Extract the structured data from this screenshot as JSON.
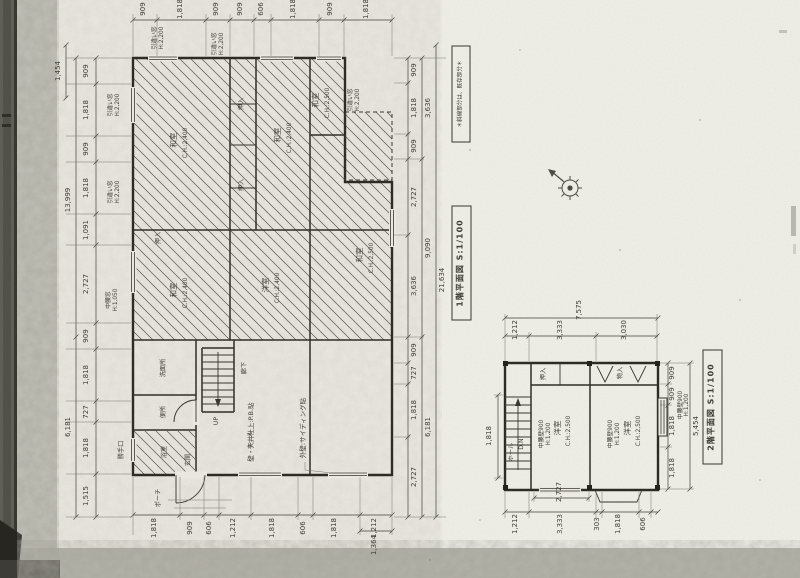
{
  "sheet": {
    "note_box": "＊斜線部分は、既存部分＊"
  },
  "floor1": {
    "title": "1階平面図 S:1/100",
    "rooms": [
      {
        "name": "和室",
        "ch": "C.H.:2,400"
      },
      {
        "name": "和室",
        "ch": "C.H.:2,400"
      },
      {
        "name": "和室",
        "ch": "C.H.:2,500"
      },
      {
        "name": "和室",
        "ch": "C.H.:2,500"
      },
      {
        "name": "和室",
        "ch": "C.H.:2,400"
      },
      {
        "name": "洋室",
        "ch": "C.H.:2,400"
      }
    ],
    "closets": [
      "押入",
      "押入",
      "押入"
    ],
    "labels": {
      "wash": "洗面所",
      "toilet": "便所",
      "bath": "浴室",
      "corridor": "廊下",
      "up": "UP",
      "hall": "ホール",
      "entrance": "玄関",
      "porch": "ポーチ",
      "kitchen_door": "勝手口"
    },
    "notes": {
      "wall": "壁・天井仕上:P.B.貼",
      "exterior": "外壁:サイディング貼"
    },
    "tags": [
      {
        "l1": "引違い窓",
        "l2": "H:2,200"
      },
      {
        "l1": "引違い窓",
        "l2": "H:2,200"
      },
      {
        "l1": "引違い窓",
        "l2": "H:2,200"
      },
      {
        "l1": "引違い窓",
        "l2": "H:2,200"
      },
      {
        "l1": "引違い窓",
        "l2": "H:2,200"
      },
      {
        "l1": "中腰窓",
        "l2": "H:1,050"
      }
    ],
    "dims": {
      "top": [
        "909",
        "1,818",
        "909",
        "909",
        "606",
        "1,818",
        "909",
        "1,818"
      ],
      "left": [
        "909",
        "1,818",
        "909",
        "1,818",
        "1,091",
        "2,727",
        "909",
        "1,818",
        "727",
        "1,818",
        "1,515"
      ],
      "left_total_upper": "13,999",
      "left_total_lower": "6,181",
      "left_offset": "1,454",
      "right_upper": [
        "909",
        "1,818",
        "909",
        "2,727",
        "3,636"
      ],
      "right_mid": [
        "3,636",
        "9,090"
      ],
      "right_lower": [
        "909",
        "727",
        "1,818",
        "2,727"
      ],
      "right_lower_total": "6,181",
      "grand_total": "21,634",
      "bottom": [
        "1,818",
        "909",
        "606",
        "1,212",
        "1,818",
        "606",
        "1,818",
        "1,212"
      ],
      "bottom_outer": "1,364"
    }
  },
  "floor2": {
    "title": "2階平面図 S:1/100",
    "rooms": [
      {
        "name": "洋室",
        "ch": "C.H.:2,500",
        "koshi1": "中腰壁900",
        "koshi2": "H:1,200"
      },
      {
        "name": "洋室",
        "ch": "C.H.:2,500",
        "koshi1": "中腰壁900",
        "koshi2": "H:1,200"
      }
    ],
    "closet": "押入",
    "storage": "物入",
    "hall": "ホール",
    "down": "D.N",
    "tag1": "中腰壁900",
    "tag2": "H:1,200",
    "dims": {
      "top": [
        "1,212",
        "3,333",
        "3,030"
      ],
      "top_total": "7,575",
      "bottom": [
        "1,212",
        "3,333",
        "303",
        "1,818",
        "606"
      ],
      "bottom_inner": "2,727",
      "right": [
        "909",
        "909",
        "1,818",
        "1,818"
      ],
      "right_total": "5,454",
      "left": "1,818"
    }
  },
  "icons": {
    "compass": "north-arrow-icon"
  }
}
